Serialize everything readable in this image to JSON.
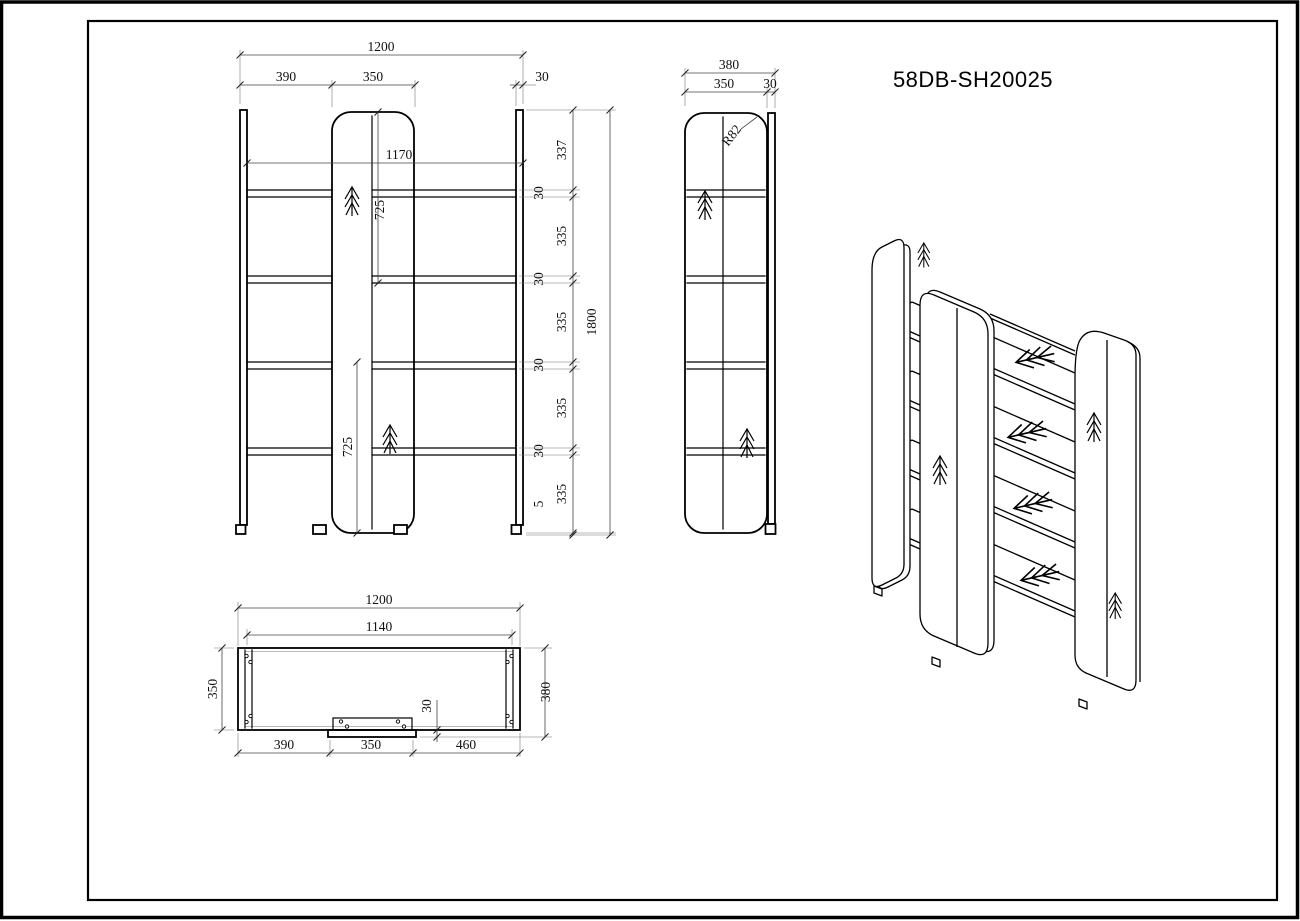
{
  "title": "58DB-SH20025",
  "front_view": {
    "dims": {
      "overall_width": "1200",
      "seg_left": "390",
      "seg_center": "350",
      "panel_thickness": "30",
      "inner_width": "1170",
      "upper_span": "725",
      "lower_span": "725",
      "overall_height": "1800",
      "chain": [
        "337",
        "30",
        "335",
        "30",
        "335",
        "30",
        "335",
        "30",
        "335",
        "5"
      ]
    }
  },
  "side_view": {
    "dims": {
      "overall_depth": "380",
      "panel_depth": "350",
      "back_thickness": "30",
      "corner_radius": "R82"
    }
  },
  "plan_view": {
    "dims": {
      "overall_width": "1200",
      "inner_width": "1140",
      "panel_depth": "350",
      "overall_depth": "380",
      "back_offset": "30",
      "seg_left": "390",
      "seg_center": "350",
      "seg_right": "460"
    }
  },
  "colors": {
    "line": "#000000",
    "dimension": "#444444",
    "background": "#ffffff"
  }
}
